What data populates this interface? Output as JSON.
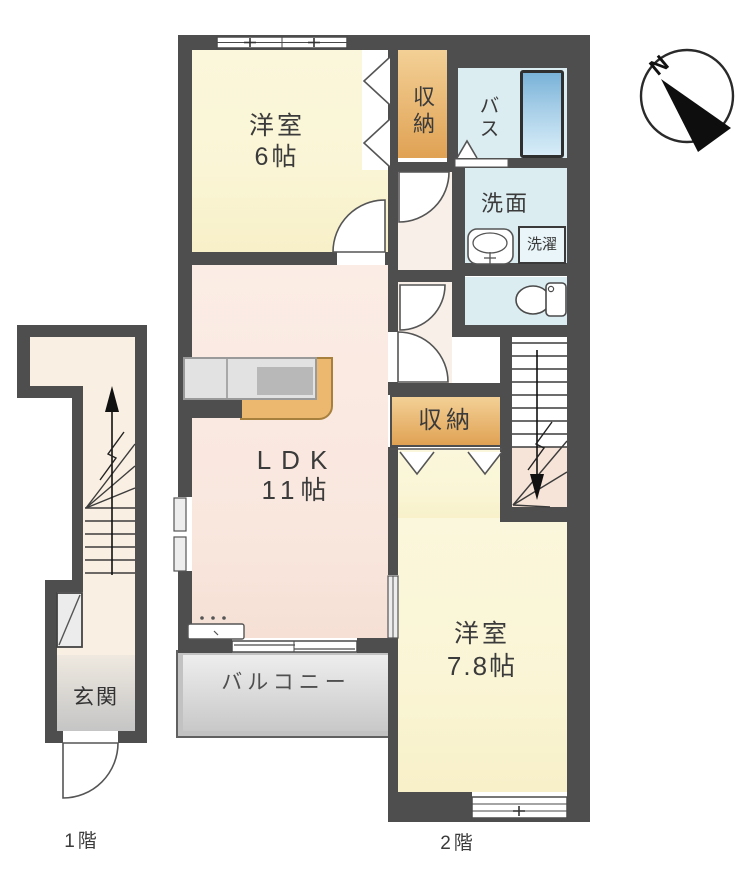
{
  "compass": {
    "north": "N"
  },
  "floor1": {
    "caption": "1階",
    "entrance": "玄関"
  },
  "floor2": {
    "caption": "2階",
    "bedroom1_name": "洋室",
    "bedroom1_size": "6帖",
    "closet_top": "収納",
    "bath": "バス",
    "washroom": "洗面",
    "laundry": "洗濯",
    "ldk_name": "LDK",
    "ldk_size": "11帖",
    "closet_mid": "収納",
    "bedroom2_name": "洋室",
    "bedroom2_size": "7.8帖",
    "balcony": "バルコニー"
  },
  "colors": {
    "wall": "#4e4e4e",
    "room_yellow": "#faf5d5",
    "room_pink": "#f9e7de",
    "floor_cream": "#f8f0e8",
    "floor_cream_1f": "#f9efe2",
    "water_blue": "#dcedf2",
    "closet_orange_top": "#f3d096",
    "closet_orange_bottom": "#e0a254",
    "counter_tan": "#ecb870",
    "counter_gray": "#e2e2e2",
    "balcony_gray_top": "#f0f0f0",
    "balcony_gray_bottom": "#c6c6c6",
    "tub_blue_top": "#79b2d8",
    "tub_blue_bottom": "#d8edf8",
    "line": "#555555",
    "text": "#3b3b3b"
  }
}
